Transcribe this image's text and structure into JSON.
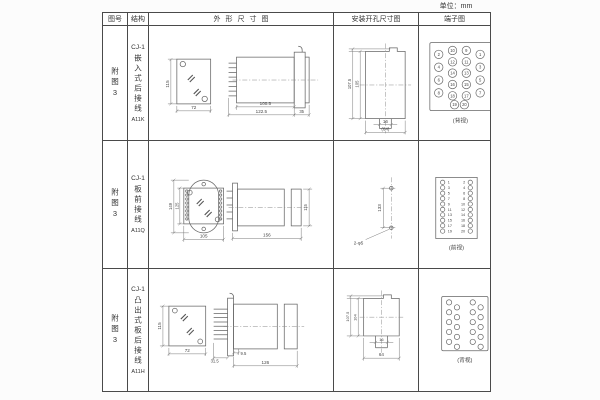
{
  "unit_label": "单位：mm",
  "table": {
    "headers": {
      "fig_no": "图号",
      "structure": "结构",
      "outline": "外形尺寸图",
      "mounting": "安装开孔尺寸图",
      "terminal": "端子图"
    },
    "rows": [
      {
        "fig_no": "附图3",
        "model_prefix": "CJ-1",
        "structure": "嵌入式后接线",
        "model": "A11K",
        "outline": {
          "front_h": "115",
          "front_w": "72",
          "body_len": "100.5",
          "total_len": "122.5",
          "panel_w": "35"
        },
        "mounting": {
          "outer_h": "107.5",
          "inner_h": "105",
          "slot_w": "16",
          "total_w": "(64)"
        },
        "terminal": {
          "caption": "(背视)",
          "outer_left": [
            2,
            4,
            6,
            8
          ],
          "inner_left": [
            10,
            12,
            14,
            16,
            18
          ],
          "inner_right": [
            9,
            11,
            13,
            15,
            17
          ],
          "outer_right": [
            1,
            3,
            5,
            7
          ],
          "bottom": [
            19,
            20
          ]
        }
      },
      {
        "fig_no": "附图3",
        "model_prefix": "CJ-1",
        "structure": "板前接线",
        "model": "A11Q",
        "outline": {
          "flange_h": "149",
          "body_h": "125",
          "front_w": "105",
          "side_len": "156",
          "side_h": "115"
        },
        "mounting": {
          "hole_spacing": "133",
          "holes_label": "2-φ5"
        },
        "terminal": {
          "caption": "(前视)",
          "left": [
            1,
            3,
            5,
            7,
            9,
            11,
            13,
            15,
            17,
            19
          ],
          "right": [
            2,
            4,
            6,
            8,
            10,
            12,
            14,
            16,
            18,
            20
          ]
        }
      },
      {
        "fig_no": "附图3",
        "model_prefix": "CJ-1",
        "structure": "凸出式板后接线",
        "model": "A11H",
        "outline": {
          "front_h": "115",
          "front_w": "72",
          "pin_len": "31.5",
          "gap": "9.5",
          "total_len": "126"
        },
        "mounting": {
          "outer_h": "107.5",
          "inner_h": "104",
          "slot_w": "16",
          "total_w": "64"
        },
        "terminal": {
          "caption": "(背视)"
        }
      }
    ]
  }
}
